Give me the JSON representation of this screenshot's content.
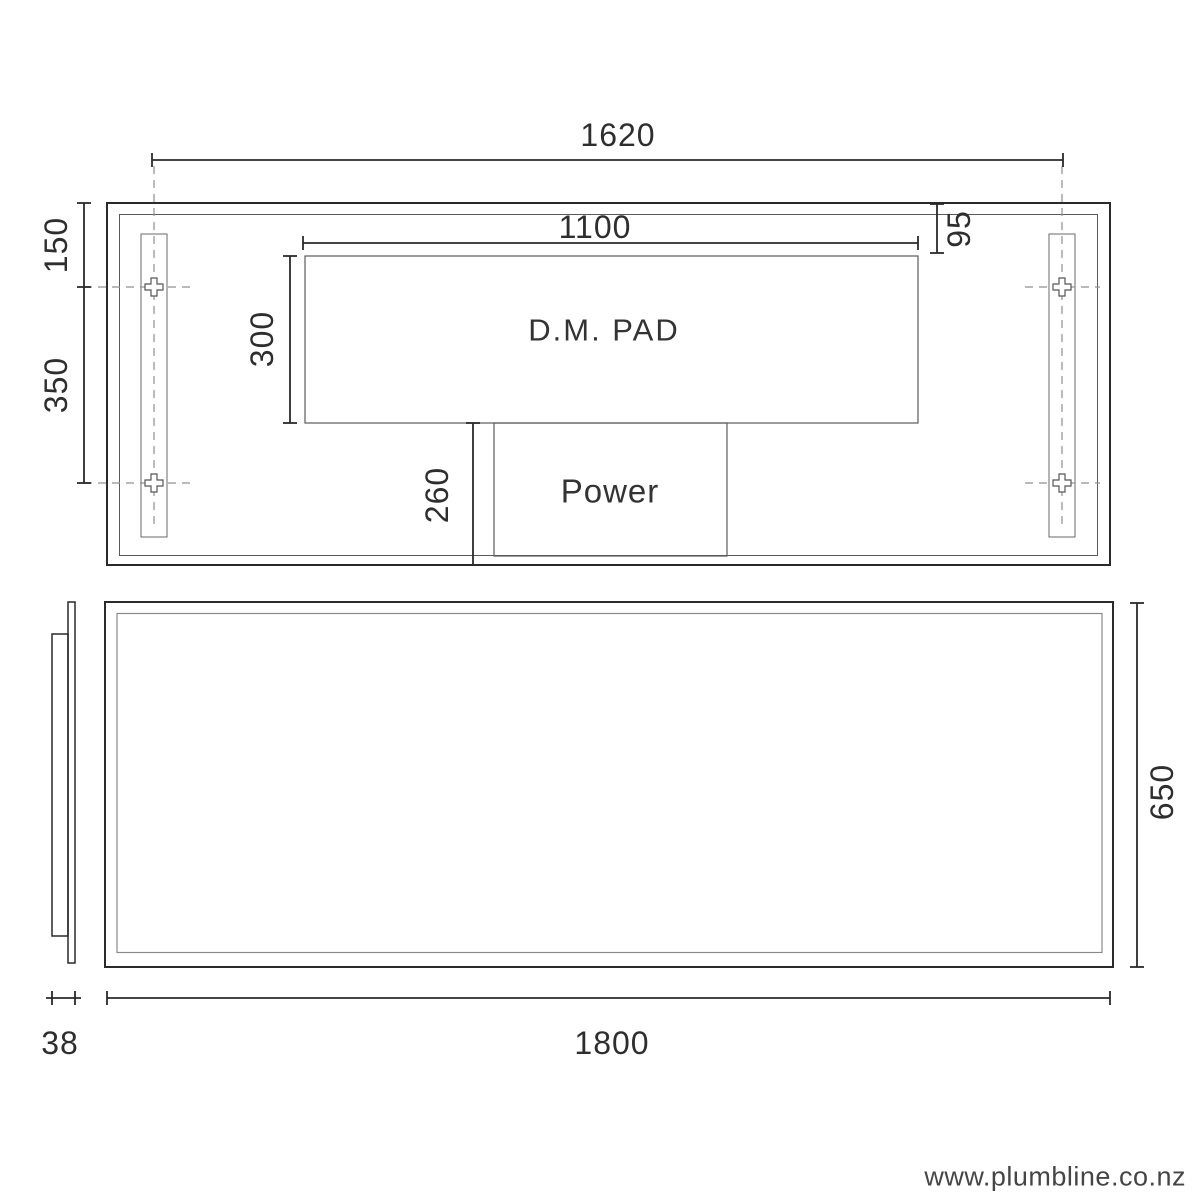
{
  "top_view": {
    "dim_mount_width": "1620",
    "dim_top_to_hole": "150",
    "dim_hole_spacing": "350",
    "dim_pad_width": "1100",
    "dim_pad_height": "300",
    "dim_pad_top_offset": "95",
    "dim_power_bottom_offset": "260",
    "pad_label": "D.M. PAD",
    "power_label": "Power"
  },
  "front_view": {
    "dim_height": "650",
    "dim_width": "1800"
  },
  "side_view": {
    "dim_depth": "38"
  },
  "footer": {
    "website": "www.plumbline.co.nz"
  },
  "colors": {
    "outline": "#2a2a2a",
    "thin_line": "#5a5a5a",
    "dashed_line": "#909090",
    "text": "#2e2e2e"
  }
}
